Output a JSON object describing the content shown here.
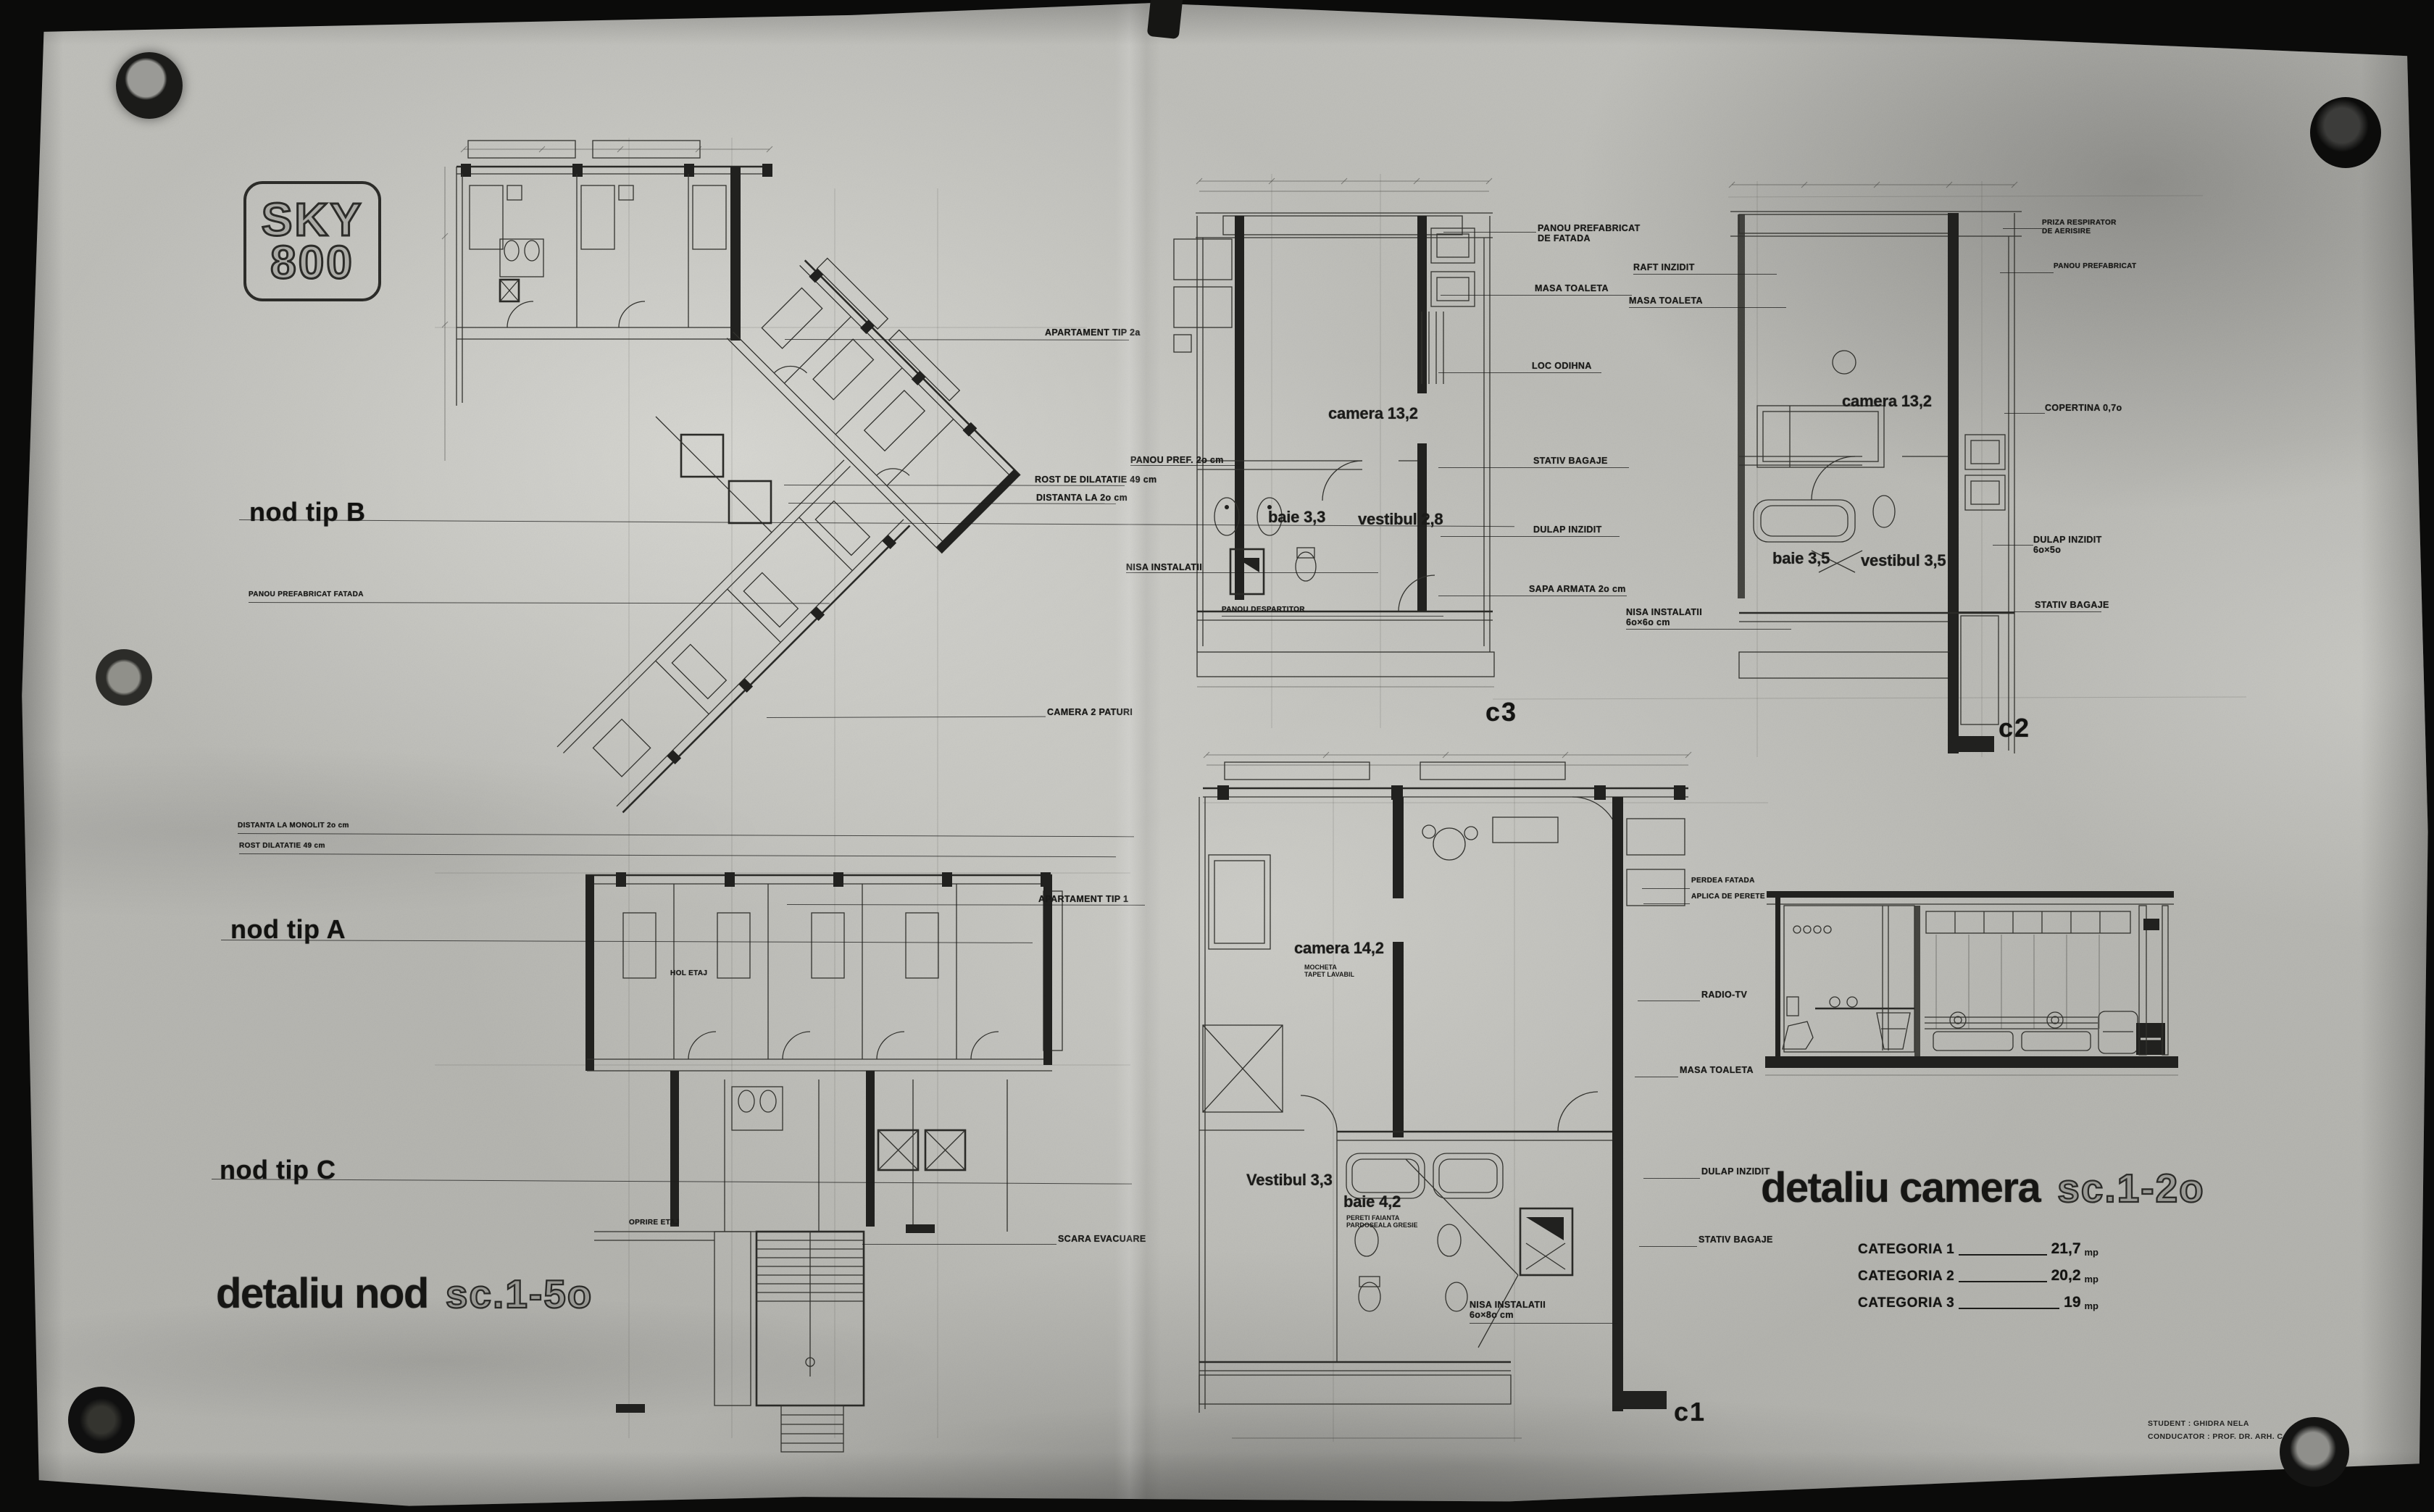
{
  "palette": {
    "background": "#0b0b0a",
    "paper": "#bdbdb8",
    "ink": "#21211f"
  },
  "logo": {
    "line1": "SKY",
    "line2": "800"
  },
  "titles": {
    "nod": {
      "text": "detaliu nod",
      "scale": "sc.1-5o"
    },
    "camera": {
      "text": "detaliu camera",
      "scale": "sc.1-2o"
    }
  },
  "node_labels": [
    {
      "id": "nod-b",
      "text": "nod tip B"
    },
    {
      "id": "nod-a",
      "text": "nod tip A"
    },
    {
      "id": "nod-c",
      "text": "nod tip C"
    }
  ],
  "section_labels": [
    {
      "id": "sec-c3",
      "text": "c3"
    },
    {
      "id": "sec-c2",
      "text": "c2"
    },
    {
      "id": "sec-c1",
      "text": "c1"
    }
  ],
  "room_labels": [
    {
      "id": "c3-camera",
      "text": "camera 13,2"
    },
    {
      "id": "c3-baie",
      "text": "baie 3,3"
    },
    {
      "id": "c3-vestibul",
      "text": "vestibul 2,8"
    },
    {
      "id": "c2-camera",
      "text": "camera 13,2"
    },
    {
      "id": "c2-baie",
      "text": "baie 3,5"
    },
    {
      "id": "c2-vestibul",
      "text": "vestibul 3,5"
    },
    {
      "id": "c1-camera",
      "text": "camera 14,2"
    },
    {
      "id": "c1-vestibul",
      "text": "Vestibul 3,3"
    },
    {
      "id": "c1-baie",
      "text": "baie 4,2"
    }
  ],
  "room_notes": [
    {
      "id": "c1-camera-note",
      "text": "MOCHETA\nTAPET LAVABIL"
    },
    {
      "id": "c1-baie-note",
      "text": "PERETI FAIANTA\nPARDOSEALA GRESIE"
    }
  ],
  "annotations": [
    {
      "id": "panou-fatada-left",
      "text": "PANOU PREFABRICAT FATADA"
    },
    {
      "id": "dist-monolit",
      "text": "DISTANTA LA MONOLIT 2o cm"
    },
    {
      "id": "rost-dilatatie-left",
      "text": "ROST DILATATIE 49 cm"
    },
    {
      "id": "apart-2a",
      "text": "APARTAMENT TIP 2a"
    },
    {
      "id": "panou-pref-20",
      "text": "PANOU PREF. 2o cm"
    },
    {
      "id": "rost-dilatatie-49",
      "text": "ROST DE DILATATIE 49 cm"
    },
    {
      "id": "distanta-20",
      "text": "DISTANTA LA 2o cm"
    },
    {
      "id": "camera-2-paturi",
      "text": "CAMERA 2 PATURI"
    },
    {
      "id": "apart-1",
      "text": "APARTAMENT TIP 1"
    },
    {
      "id": "scara-evacuare",
      "text": "SCARA EVACUARE"
    },
    {
      "id": "hol-etaj",
      "text": "HOL ETAJ"
    },
    {
      "id": "oprire-etaj",
      "text": "OPRIRE ETAJ"
    },
    {
      "id": "nisa-c3",
      "text": "NISA INSTALATII"
    },
    {
      "id": "panou-despartitor",
      "text": "PANOU DESPARTITOR"
    },
    {
      "id": "panou-pref-fatada-c3",
      "text": "PANOU PREFABRICAT\nDE FATADA"
    },
    {
      "id": "masa-toaleta-c3",
      "text": "MASA TOALETA"
    },
    {
      "id": "loc-odihna",
      "text": "LOC ODIHNA"
    },
    {
      "id": "stativ-bagaje-c3",
      "text": "STATIV BAGAJE"
    },
    {
      "id": "dulap-inzidit-c3",
      "text": "DULAP INZIDIT"
    },
    {
      "id": "sapa-armata",
      "text": "SAPA ARMATA 2o cm"
    },
    {
      "id": "raft-inzidit",
      "text": "RAFT INZIDIT"
    },
    {
      "id": "masa-toaleta-c2",
      "text": "MASA TOALETA"
    },
    {
      "id": "nisa-c2",
      "text": "NISA INSTALATII\n6o×6o cm"
    },
    {
      "id": "priza-aerisire",
      "text": "PRIZA RESPIRATOR\nDE AERISIRE"
    },
    {
      "id": "panou-pref-c2",
      "text": "PANOU PREFABRICAT"
    },
    {
      "id": "copertina",
      "text": "COPERTINA 0,7o"
    },
    {
      "id": "dulap-inzidit-c2",
      "text": "DULAP INZIDIT\n6o×5o"
    },
    {
      "id": "stativ-bagaje-c2",
      "text": "STATIV BAGAJE"
    },
    {
      "id": "perdea-fatada",
      "text": "PERDEA FATADA"
    },
    {
      "id": "aplica-perete",
      "text": "APLICA DE PERETE"
    },
    {
      "id": "radio-tv",
      "text": "RADIO-TV"
    },
    {
      "id": "masa-toaleta-c1",
      "text": "MASA TOALETA"
    },
    {
      "id": "dulap-inzidit-c1",
      "text": "DULAP INZIDIT"
    },
    {
      "id": "stativ-bagaje-c1",
      "text": "STATIV BAGAJE"
    },
    {
      "id": "nisa-c1",
      "text": "NISA INSTALATII\n6o×8o cm"
    }
  ],
  "categories": {
    "rows": [
      {
        "label": "CATEGORIA 1",
        "value": "21,7",
        "unit": "mp"
      },
      {
        "label": "CATEGORIA 2",
        "value": "20,2",
        "unit": "mp"
      },
      {
        "label": "CATEGORIA 3",
        "value": "19",
        "unit": "mp"
      }
    ]
  },
  "credits": {
    "line1": "STUDENT : GHIDRA NELA",
    "line2": "CONDUCATOR : PROF. DR. ARH. C. LAZARESCU"
  }
}
